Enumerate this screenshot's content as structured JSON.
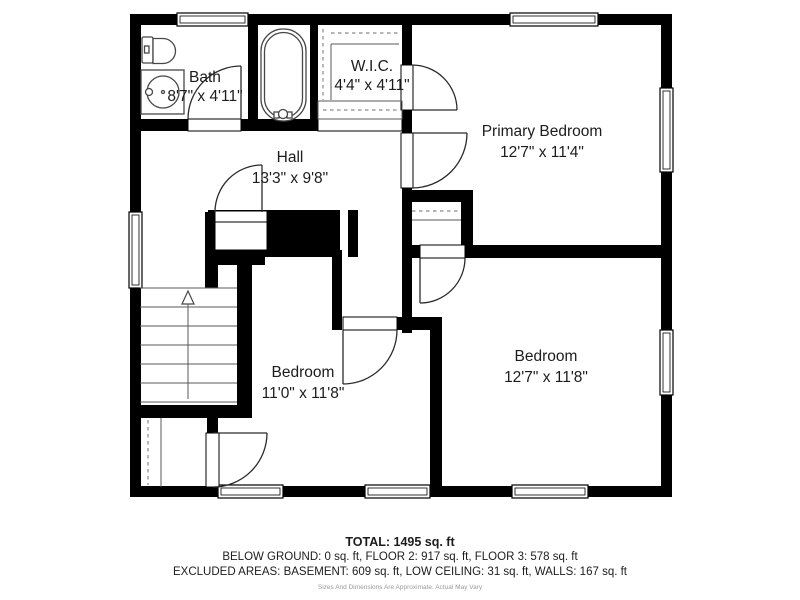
{
  "plan": {
    "rooms": [
      {
        "name": "Bath",
        "dims": "8'7\" x 4'11\""
      },
      {
        "name": "W.I.C.",
        "dims": "4'4\" x 4'11\""
      },
      {
        "name": "Hall",
        "dims": "13'3\" x 9'8\""
      },
      {
        "name": "Primary Bedroom",
        "dims": "12'7\" x 11'4\""
      },
      {
        "name": "Bedroom",
        "dims": "11'0\" x 11'8\""
      },
      {
        "name": "Bedroom",
        "dims": "12'7\" x 11'8\""
      }
    ],
    "stairs_direction": "up"
  },
  "summary": {
    "total": "TOTAL: 1495 sq. ft",
    "floors": "BELOW GROUND: 0 sq. ft, FLOOR 2: 917 sq. ft, FLOOR 3: 578 sq. ft",
    "excluded": "EXCLUDED AREAS: BASEMENT: 609 sq. ft, LOW CEILING: 31 sq. ft, WALLS: 167 sq. ft",
    "disclaimer": "Sizes And Dimensions Are Approximate. Actual May Vary"
  },
  "colors": {
    "wall": "#000000",
    "background": "#ffffff",
    "fixture_line": "#474747",
    "closet_dash": "#8a8a8a",
    "disclaimer_text": "#9a9a9a"
  }
}
